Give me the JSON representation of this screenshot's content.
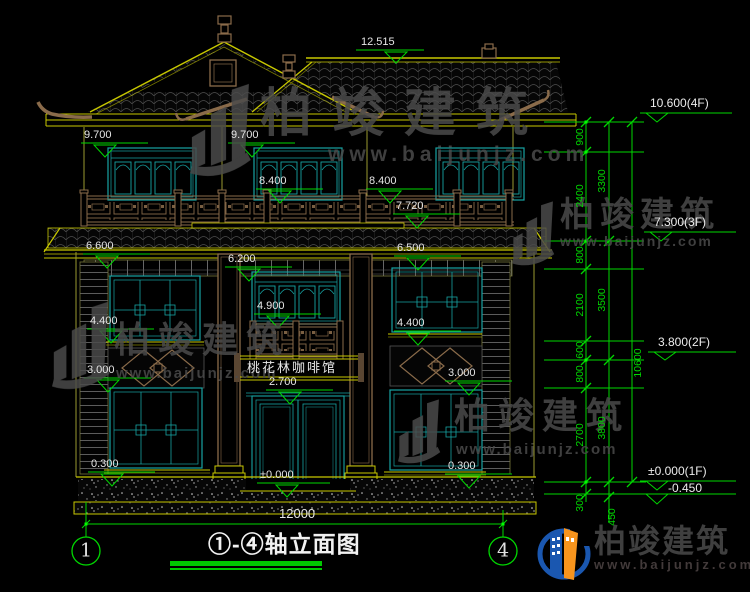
{
  "drawing_title": {
    "text": "①-④轴立面图"
  },
  "axes": {
    "left": "1",
    "right": "4"
  },
  "sign": {
    "text": "桃花林咖啡馆"
  },
  "face_marks": [
    "12.515",
    "9.700",
    "9.700",
    "8.400",
    "8.400",
    "7.720",
    "6.600",
    "6.500",
    "6.200",
    "4.900",
    "4.400",
    "4.400",
    "3.000",
    "3.000",
    "2.700",
    "0.300",
    "0.300",
    "±0.000",
    "12000"
  ],
  "floor_levels": [
    "10.600(4F)",
    "7.300(3F)",
    "3.800(2F)",
    "±0.000(1F)",
    "-0.450"
  ],
  "chain_dims": [
    "900",
    "2400",
    "3300",
    "800",
    "2100",
    "3500",
    "600",
    "800",
    "10600",
    "2700",
    "3800",
    "300",
    "450"
  ],
  "watermark": {
    "brand": "柏竣建筑",
    "url": "www.baijunjz.com"
  },
  "logo": {
    "brand": "柏竣建筑",
    "url": "www.baijunjz.com"
  },
  "colors": {
    "background": "#000000",
    "dimension_green": "#00d800",
    "cad_yellow": "#c8c800",
    "window_teal": "#17a3a3",
    "wood_brown": "#8a6b4a",
    "label_white": "#e6e6e6",
    "watermark_gray": "#4b4b4b",
    "logo_blue": "#1a57b0",
    "logo_orange": "#f7941d"
  }
}
